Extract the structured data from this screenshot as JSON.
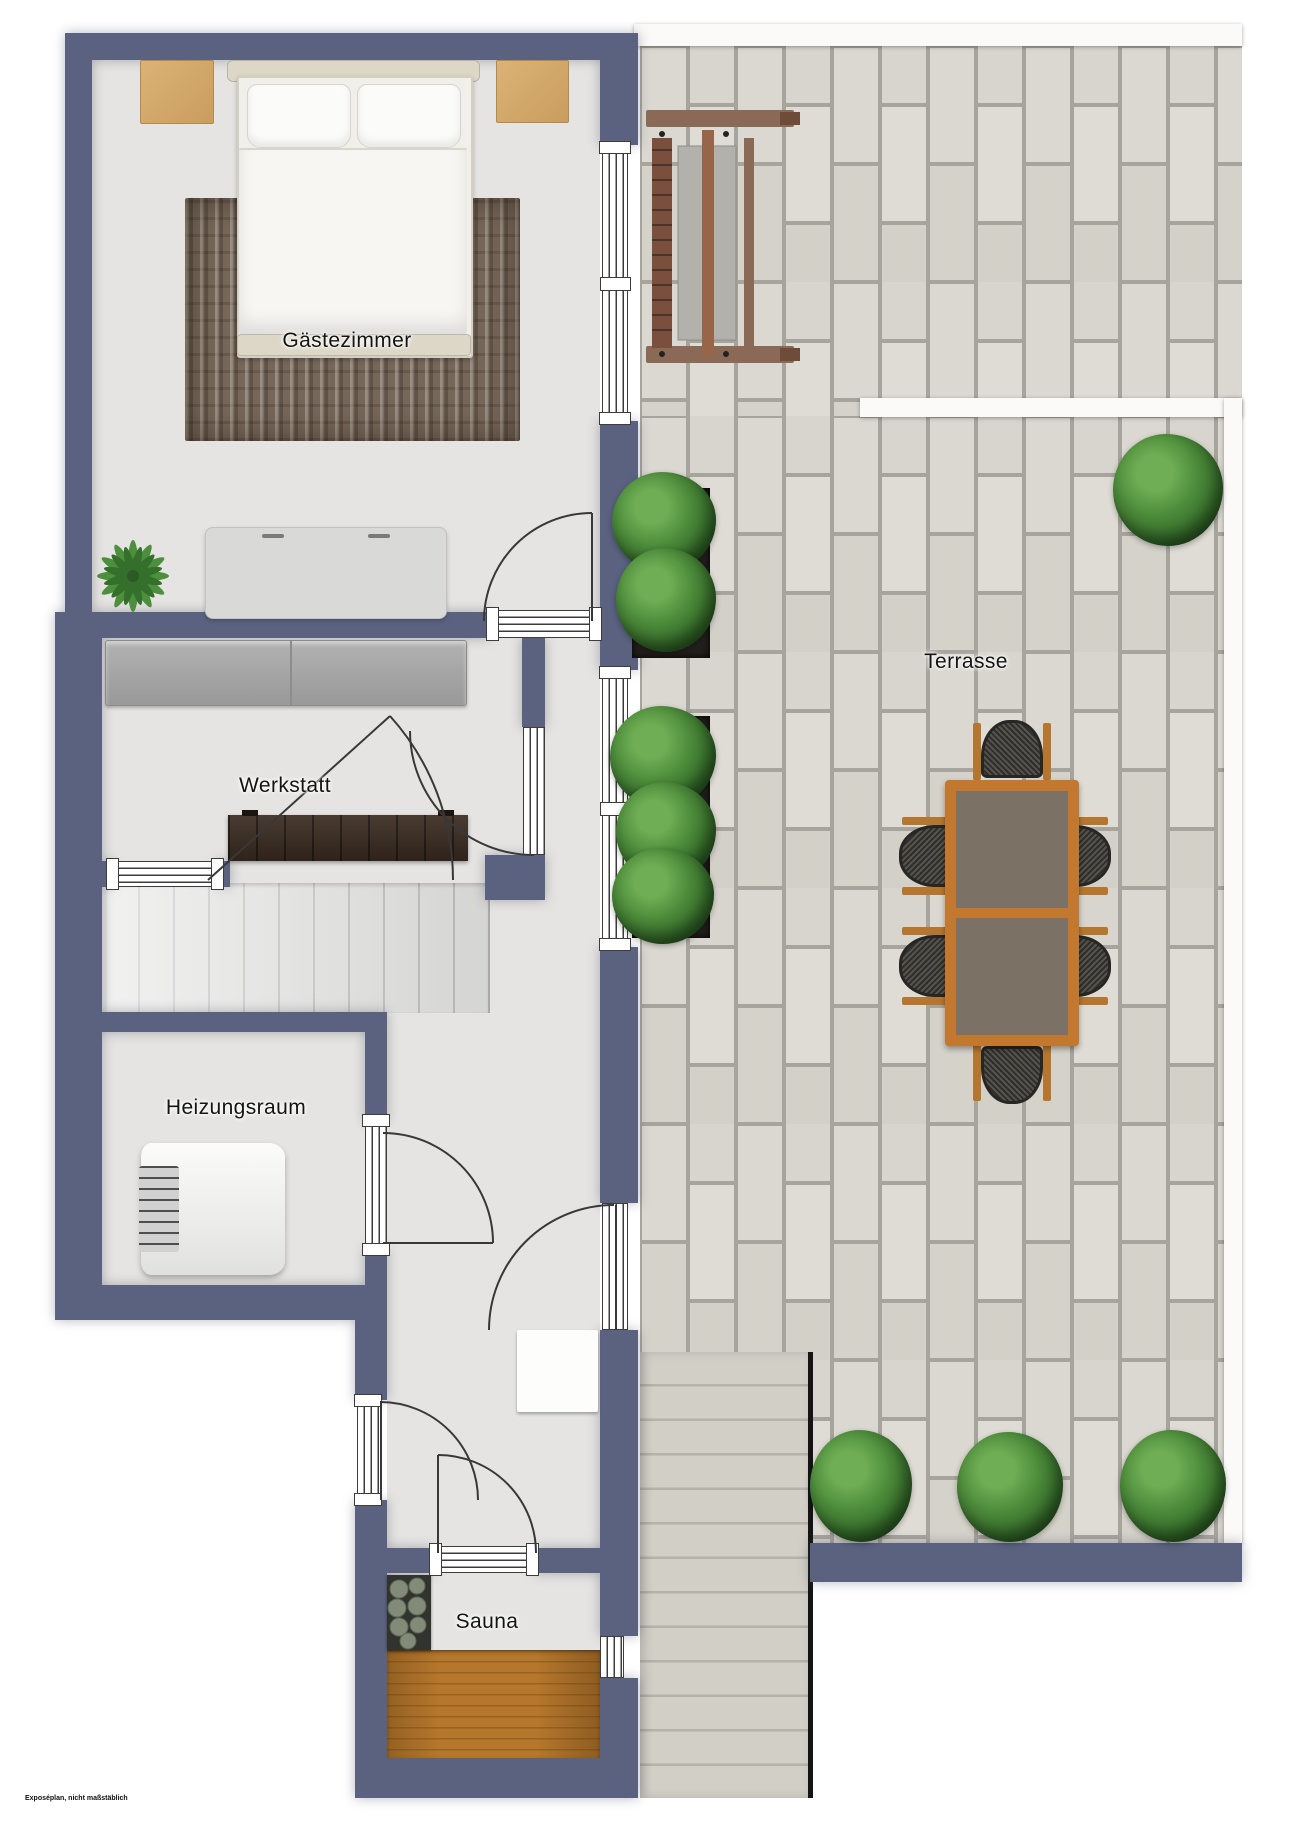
{
  "plan": {
    "type": "floor-plan",
    "watermark": "Exposéplan, nicht maßstäblich"
  },
  "rooms": [
    {
      "id": "gaestezimmer",
      "label": "Gästezimmer"
    },
    {
      "id": "werkstatt",
      "label": "Werkstatt"
    },
    {
      "id": "heizungsraum",
      "label": "Heizungsraum"
    },
    {
      "id": "sauna",
      "label": "Sauna"
    },
    {
      "id": "terrasse",
      "label": "Terrasse"
    }
  ],
  "furniture": [
    "double-bed",
    "nightstand-left",
    "nightstand-right",
    "area-rug",
    "sideboard",
    "potted-palm",
    "storage-cabinet",
    "workbench",
    "interior-stairs",
    "boiler",
    "utility-mat",
    "sauna-heater",
    "sauna-wood-floor",
    "porch-swing",
    "dining-table",
    "six-dining-chairs",
    "planter-boxes",
    "bushes",
    "exterior-stairs"
  ],
  "colors": {
    "wall": "#5a6280",
    "floor": "#e5e4e2",
    "tile": "#dbd8d1",
    "grout": "#a7a49d",
    "accent_wood": "#c2782e",
    "dark_wood": "#3a2b21",
    "sauna_wood": "#b5772b",
    "plant_green": "#4d8c3b",
    "table_top": "#7b7265",
    "exterior_stairs": "#cfccc4"
  }
}
